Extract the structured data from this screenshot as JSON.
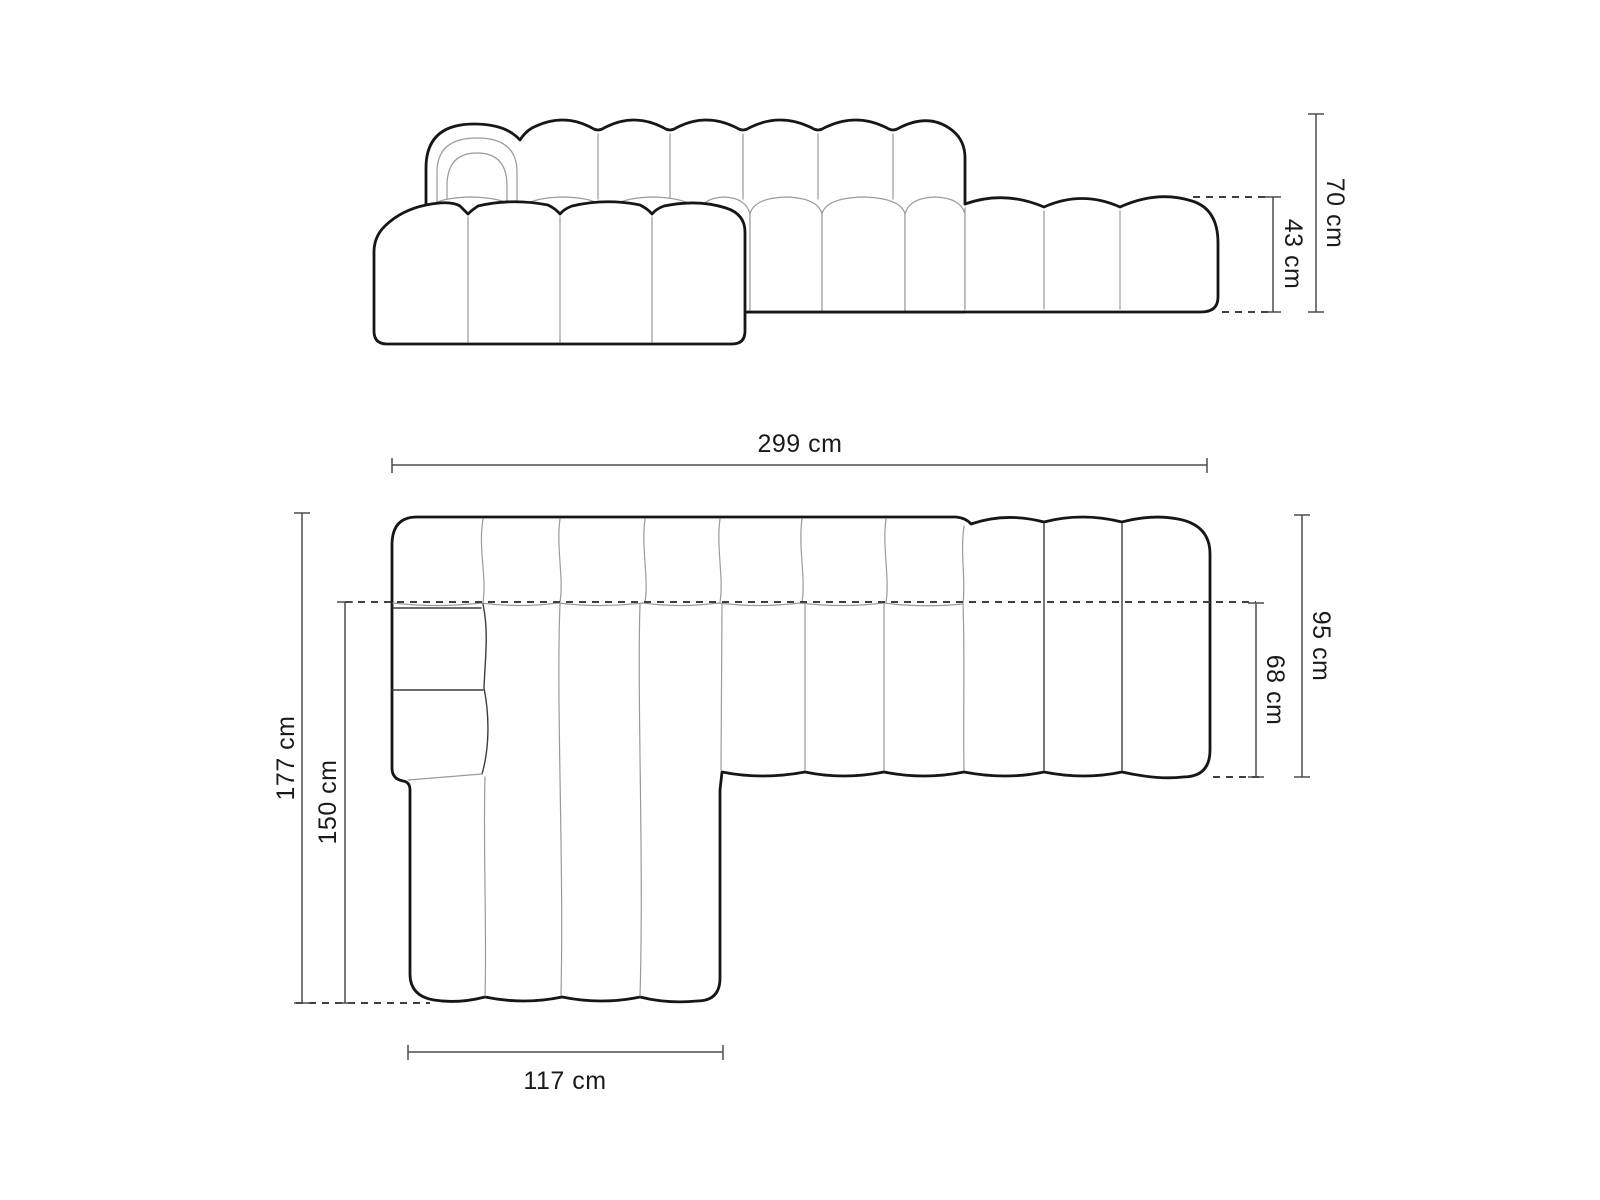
{
  "diagram": {
    "kind": "sofa-dimension-drawing",
    "unit": "cm",
    "front_view": {
      "overall_height_label": "70 cm",
      "seat_height_label": "43 cm"
    },
    "top_view": {
      "overall_width_label": "299 cm",
      "overall_depth_label": "177 cm",
      "chaise_length_label": "150 cm",
      "chaise_width_label": "117 cm",
      "sofa_depth_label": "95 cm",
      "seat_depth_label": "68 cm"
    }
  },
  "colors": {
    "background": "#ffffff",
    "outline": "#161616",
    "seam": "#9a9a9a",
    "dimension_line": "#4c4c4c",
    "dashed_line": "#3f3f3f",
    "label_text": "#1a1a1a"
  }
}
